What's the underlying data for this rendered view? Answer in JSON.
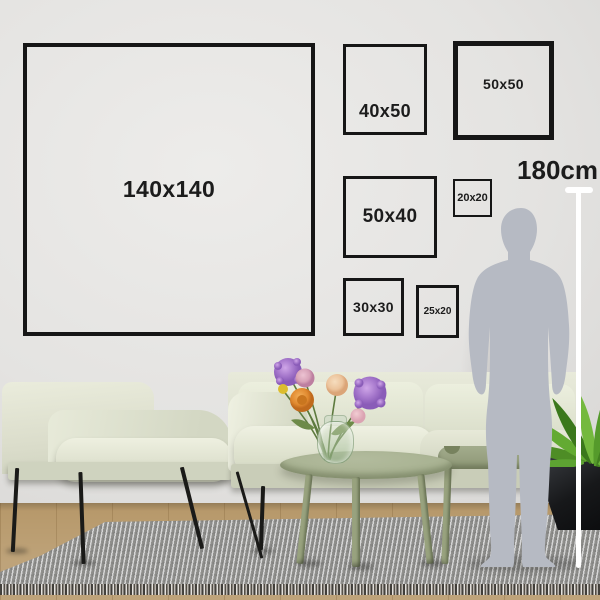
{
  "frames": [
    {
      "label": "140x140"
    },
    {
      "label": "40x50"
    },
    {
      "label": "50x50"
    },
    {
      "label": "50x40"
    },
    {
      "label": "20x20"
    },
    {
      "label": "30x30"
    },
    {
      "label": "25x20"
    }
  ],
  "scale": {
    "label": "180cm"
  },
  "colors": {
    "frame_border": "#161616",
    "label_text": "#1c1c1c",
    "measure_line": "#ffffff",
    "silhouette": "#b6bac3",
    "wall": "#e0dfdd",
    "sofa": "#dde0cf",
    "table": "#a6b08f",
    "rug": "#a5a5a3",
    "floor": "#b7996b",
    "plant": "#5da332",
    "pot": "#1a1c1e",
    "flower_purple": "#a678cc",
    "flower_orange": "#e0892f",
    "flower_pink": "#d8a3b8",
    "flower_peach": "#ecc49c",
    "flower_yellow": "#dcbd2e"
  }
}
